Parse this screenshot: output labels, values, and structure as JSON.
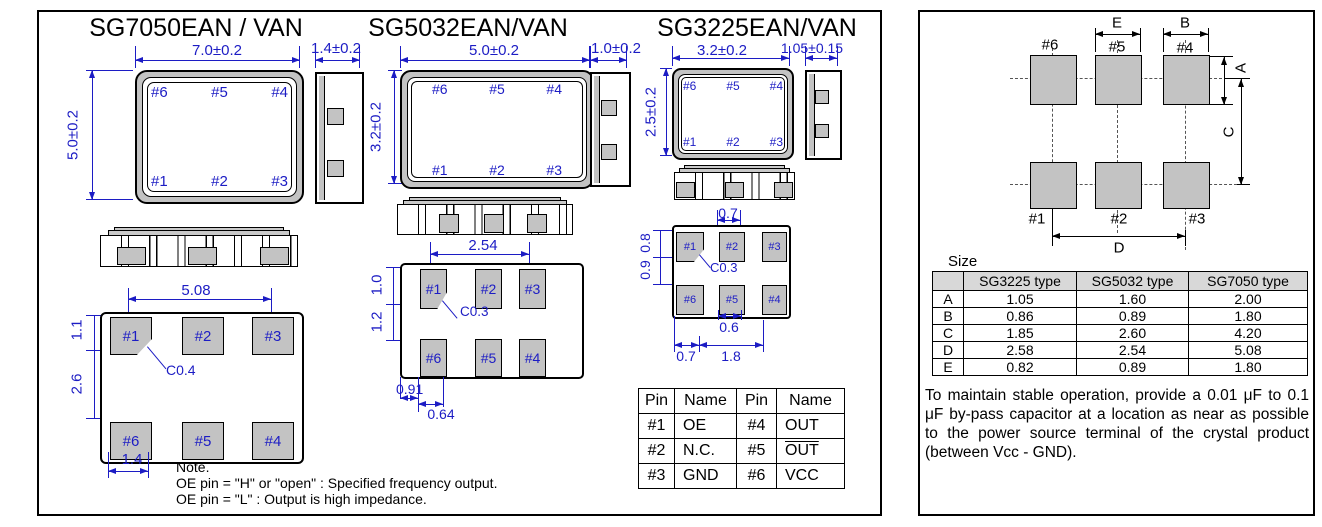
{
  "colors": {
    "accent_blue": "#1c1cc4",
    "pad_gray": "#c3c3c3",
    "table_header_gray": "#d8d8d8"
  },
  "left_panel": {
    "sg7050": {
      "title": "SG7050EAN / VAN",
      "top_view": {
        "width_dim": "7.0±0.2",
        "height_dim": "5.0±0.2",
        "side_dim": "1.4±0.2",
        "top_pins": [
          "#6",
          "#5",
          "#4"
        ],
        "bottom_pins": [
          "#1",
          "#2",
          "#3"
        ]
      },
      "bottom_view": {
        "pad_span_dim": "5.08",
        "pad_height_dim": "1.1",
        "row_gap_dim": "2.6",
        "chamfer_label": "C0.4",
        "pad_width_dim": "1.4",
        "top_pads": [
          "#1",
          "#2",
          "#3"
        ],
        "bottom_pads": [
          "#6",
          "#5",
          "#4"
        ]
      }
    },
    "sg5032": {
      "title": "SG5032EAN/VAN",
      "top_view": {
        "width_dim": "5.0±0.2",
        "height_dim": "3.2±0.2",
        "side_dim": "1.0±0.2",
        "top_pins": [
          "#6",
          "#5",
          "#4"
        ],
        "bottom_pins": [
          "#1",
          "#2",
          "#3"
        ]
      },
      "bottom_view": {
        "pad_span_dim": "2.54",
        "pad_height_dim": "1.0",
        "row_gap_dim": "1.2",
        "chamfer_label": "C0.3",
        "pad_offset_dim": "0.91",
        "pad_width_dim": "0.64",
        "top_pads": [
          "#1",
          "#2",
          "#3"
        ],
        "bottom_pads": [
          "#6",
          "#5",
          "#4"
        ]
      }
    },
    "sg3225": {
      "title": "SG3225EAN/VAN",
      "top_view": {
        "width_dim": "3.2±0.2",
        "height_dim": "2.5±0.2",
        "side_dim": "1.05±0.15",
        "top_pins": [
          "#6",
          "#5",
          "#4"
        ],
        "bottom_pins": [
          "#1",
          "#2",
          "#3"
        ]
      },
      "bottom_view": {
        "pad2_width_dim": "0.7",
        "pad_height_dim": "0.8",
        "row_gap_dim": "0.9",
        "chamfer_label": "C0.3",
        "pad5_width_dim": "0.6",
        "bottom_dim1": "0.7",
        "bottom_dim2": "1.8",
        "top_pads": [
          "#1",
          "#2",
          "#3"
        ],
        "bottom_pads": [
          "#6",
          "#5",
          "#4"
        ]
      }
    },
    "note": {
      "heading": "Note.",
      "line1": "OE pin = \"H\" or \"open\" : Specified frequency output.",
      "line2": "OE pin = \"L\" : Output is high impedance."
    },
    "pin_table": {
      "headers": [
        "Pin",
        "Name",
        "Pin",
        "Name"
      ],
      "rows": [
        [
          "#1",
          "OE",
          "#4",
          "OUT"
        ],
        [
          "#2",
          "N.C.",
          "#5",
          "OUT"
        ],
        [
          "#3",
          "GND",
          "#6",
          "VCC"
        ]
      ]
    }
  },
  "right_panel": {
    "pad_diagram": {
      "top_labels": [
        "#6",
        "#5",
        "#4"
      ],
      "bottom_labels": [
        "#1",
        "#2",
        "#3"
      ],
      "dim_a": "A",
      "dim_b": "B",
      "dim_c": "C",
      "dim_d": "D",
      "dim_e": "E"
    },
    "size_table": {
      "caption": "Size",
      "headers": [
        "",
        "SG3225 type",
        "SG5032 type",
        "SG7050 type"
      ],
      "rows": [
        [
          "A",
          "1.05",
          "1.60",
          "2.00"
        ],
        [
          "B",
          "0.86",
          "0.89",
          "1.80"
        ],
        [
          "C",
          "1.85",
          "2.60",
          "4.20"
        ],
        [
          "D",
          "2.58",
          "2.54",
          "5.08"
        ],
        [
          "E",
          "0.82",
          "0.89",
          "1.80"
        ]
      ]
    },
    "note": "To maintain stable operation, provide a 0.01 μF to 0.1 μF by-pass capacitor at a location as near as possible to the power source terminal of the crystal product (between Vcc - GND)."
  }
}
